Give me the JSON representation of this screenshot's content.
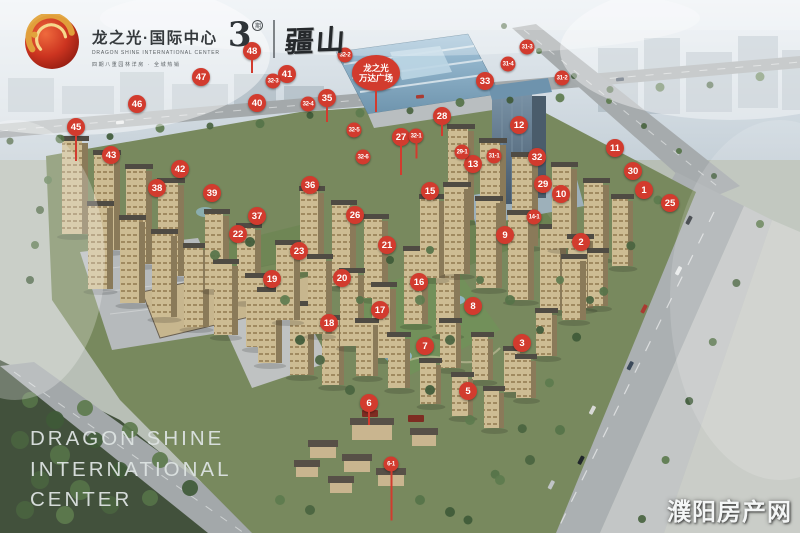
{
  "branding": {
    "logo_cn": "龙之光·国际中心",
    "logo_en": "DRAGON SHINE INTERNATIONAL CENTER",
    "tagline": "四期八重园林洋房 · 全城热销",
    "phase_number": "3",
    "phase_mark": "期",
    "sub_brand": "疆山"
  },
  "mall_label": {
    "line1": "龙之光",
    "line2": "万达广场"
  },
  "footer_title": {
    "line1": "DRAGON SHINE",
    "line2": "INTERNATIONAL",
    "line3": "CENTER"
  },
  "watermark": "濮阳房产网",
  "colors": {
    "marker_red": "#d23b2e",
    "marker_text": "#ffffff"
  },
  "markers": {
    "large": [
      {
        "label": "1",
        "x": 644,
        "y": 190
      },
      {
        "label": "2",
        "x": 581,
        "y": 242
      },
      {
        "label": "3",
        "x": 522,
        "y": 343
      },
      {
        "label": "5",
        "x": 468,
        "y": 391
      },
      {
        "label": "6",
        "x": 369,
        "y": 403,
        "stem": 14
      },
      {
        "label": "7",
        "x": 425,
        "y": 346
      },
      {
        "label": "8",
        "x": 473,
        "y": 306
      },
      {
        "label": "9",
        "x": 505,
        "y": 235
      },
      {
        "label": "10",
        "x": 561,
        "y": 194
      },
      {
        "label": "11",
        "x": 615,
        "y": 148
      },
      {
        "label": "12",
        "x": 519,
        "y": 125
      },
      {
        "label": "13",
        "x": 473,
        "y": 164
      },
      {
        "label": "15",
        "x": 430,
        "y": 191
      },
      {
        "label": "16",
        "x": 419,
        "y": 282
      },
      {
        "label": "17",
        "x": 380,
        "y": 310
      },
      {
        "label": "18",
        "x": 329,
        "y": 323
      },
      {
        "label": "19",
        "x": 272,
        "y": 279
      },
      {
        "label": "20",
        "x": 342,
        "y": 278
      },
      {
        "label": "21",
        "x": 387,
        "y": 245
      },
      {
        "label": "22",
        "x": 238,
        "y": 234
      },
      {
        "label": "23",
        "x": 299,
        "y": 251
      },
      {
        "label": "25",
        "x": 670,
        "y": 203
      },
      {
        "label": "26",
        "x": 355,
        "y": 215
      },
      {
        "label": "27",
        "x": 401,
        "y": 137,
        "stem": 30
      },
      {
        "label": "28",
        "x": 442,
        "y": 116,
        "stem": 12
      },
      {
        "label": "29",
        "x": 543,
        "y": 184
      },
      {
        "label": "30",
        "x": 633,
        "y": 171
      },
      {
        "label": "32",
        "x": 537,
        "y": 157
      },
      {
        "label": "33",
        "x": 485,
        "y": 81
      },
      {
        "label": "35",
        "x": 327,
        "y": 98,
        "stem": 16
      },
      {
        "label": "36",
        "x": 310,
        "y": 185
      },
      {
        "label": "37",
        "x": 257,
        "y": 216
      },
      {
        "label": "38",
        "x": 157,
        "y": 188
      },
      {
        "label": "39",
        "x": 212,
        "y": 193
      },
      {
        "label": "40",
        "x": 257,
        "y": 103
      },
      {
        "label": "41",
        "x": 287,
        "y": 74
      },
      {
        "label": "42",
        "x": 180,
        "y": 169
      },
      {
        "label": "43",
        "x": 111,
        "y": 155
      },
      {
        "label": "45",
        "x": 76,
        "y": 127,
        "stem": 26
      },
      {
        "label": "46",
        "x": 137,
        "y": 104
      },
      {
        "label": "47",
        "x": 201,
        "y": 77
      },
      {
        "label": "48",
        "x": 252,
        "y": 51,
        "stem": 14
      }
    ],
    "small": [
      {
        "label": "6-1",
        "x": 391,
        "y": 464,
        "stem": 50
      },
      {
        "label": "14-1",
        "x": 534,
        "y": 217
      },
      {
        "label": "29-1",
        "x": 462,
        "y": 152
      },
      {
        "label": "31-1",
        "x": 494,
        "y": 156
      },
      {
        "label": "31-2",
        "x": 562,
        "y": 78
      },
      {
        "label": "31-3",
        "x": 527,
        "y": 47
      },
      {
        "label": "31-4",
        "x": 508,
        "y": 64
      },
      {
        "label": "32-1",
        "x": 416,
        "y": 136,
        "stem": 16
      },
      {
        "label": "32-2",
        "x": 345,
        "y": 55
      },
      {
        "label": "32-3",
        "x": 273,
        "y": 81
      },
      {
        "label": "32-4",
        "x": 308,
        "y": 104
      },
      {
        "label": "32-5",
        "x": 354,
        "y": 130
      },
      {
        "label": "32-6",
        "x": 363,
        "y": 157
      }
    ]
  }
}
